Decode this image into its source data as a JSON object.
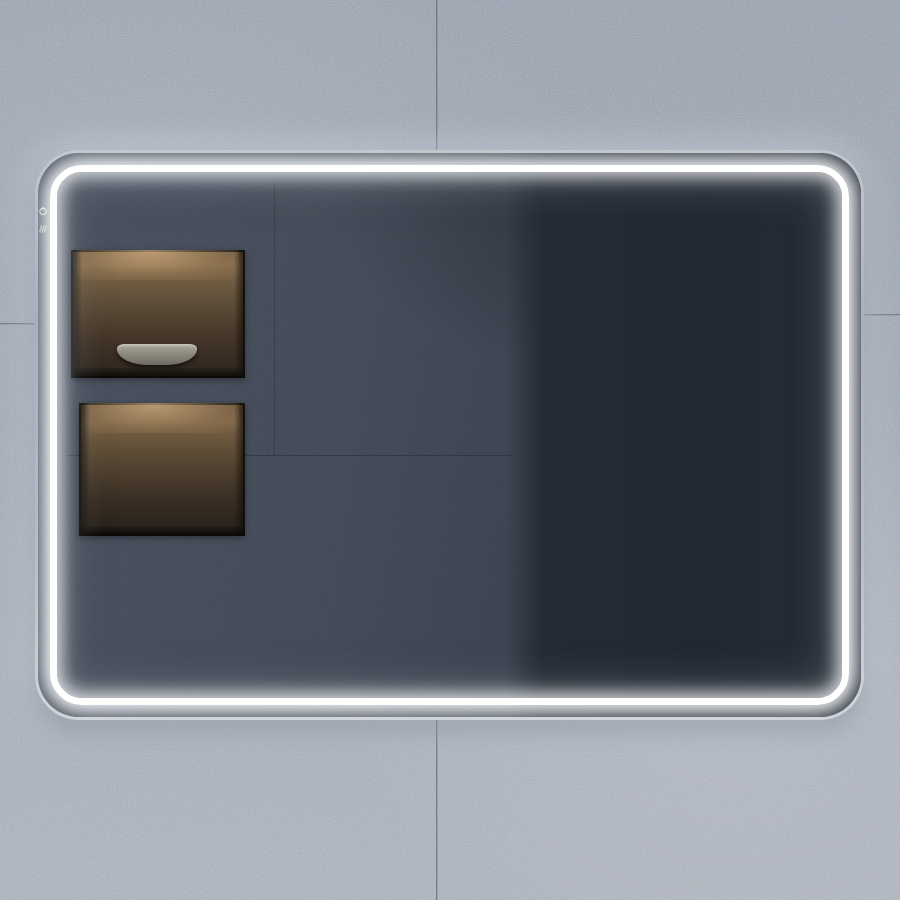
{
  "scene": {
    "description": "Backlit LED bathroom mirror with rounded corners mounted on a gray concrete tile wall; the mirror reflects a dark slate bathroom with two lit shelf niches, a matte black freestanding faucet and a slatted window view of a misty autumn forest",
    "product": "LED illuminated bathroom mirror"
  },
  "palette": {
    "wall": "#9ba3b0",
    "wall_seam": "#5c646f",
    "frame": "#c6cbd2",
    "led_core": "#ffffff",
    "led_glow": "#dcebf7",
    "reflection_wall": "#3c434f",
    "reflection_dark": "#252b34",
    "niche_glow": "#8a6f4e",
    "niche_dark": "#261f19",
    "bowl_stone": "#938f85",
    "bowl_plant": "#b5854e",
    "towel_light": "#ebedef",
    "faucet_black": "#111316",
    "forest_teal": "#14303c",
    "forest_green": "#4e7a46",
    "forest_trunk": "#101316",
    "forest_mist": "#d6d4c8",
    "forest_autumn": "#c9a14e",
    "forest_ground": "#8a6d45"
  },
  "mirror": {
    "led_ring": {
      "state": "on",
      "light_color_name": "cool white"
    },
    "touch_controls": {
      "buttons": [
        {
          "icon": "power-icon",
          "label": "power"
        },
        {
          "icon": "defog-icon",
          "label": "anti-fog"
        }
      ]
    }
  },
  "reflection": {
    "niches": [
      {
        "name": "upper-niche",
        "contents": "stone bowl with dried botanicals"
      },
      {
        "name": "lower-niche",
        "contents": "stack of folded towels"
      }
    ],
    "towels": {
      "count": 5,
      "layers": [
        {
          "w": 118,
          "color": "#b4bac1"
        },
        {
          "w": 115,
          "color": "#c2c7cd"
        },
        {
          "w": 112,
          "color": "#ced3d8"
        },
        {
          "w": 114,
          "color": "#dce0e4"
        },
        {
          "w": 104,
          "color": "#ebedef"
        }
      ]
    },
    "faucet": {
      "style": "matte black freestanding tub filler"
    },
    "window": {
      "view": "misty autumn forest",
      "strip_count": 3
    }
  }
}
